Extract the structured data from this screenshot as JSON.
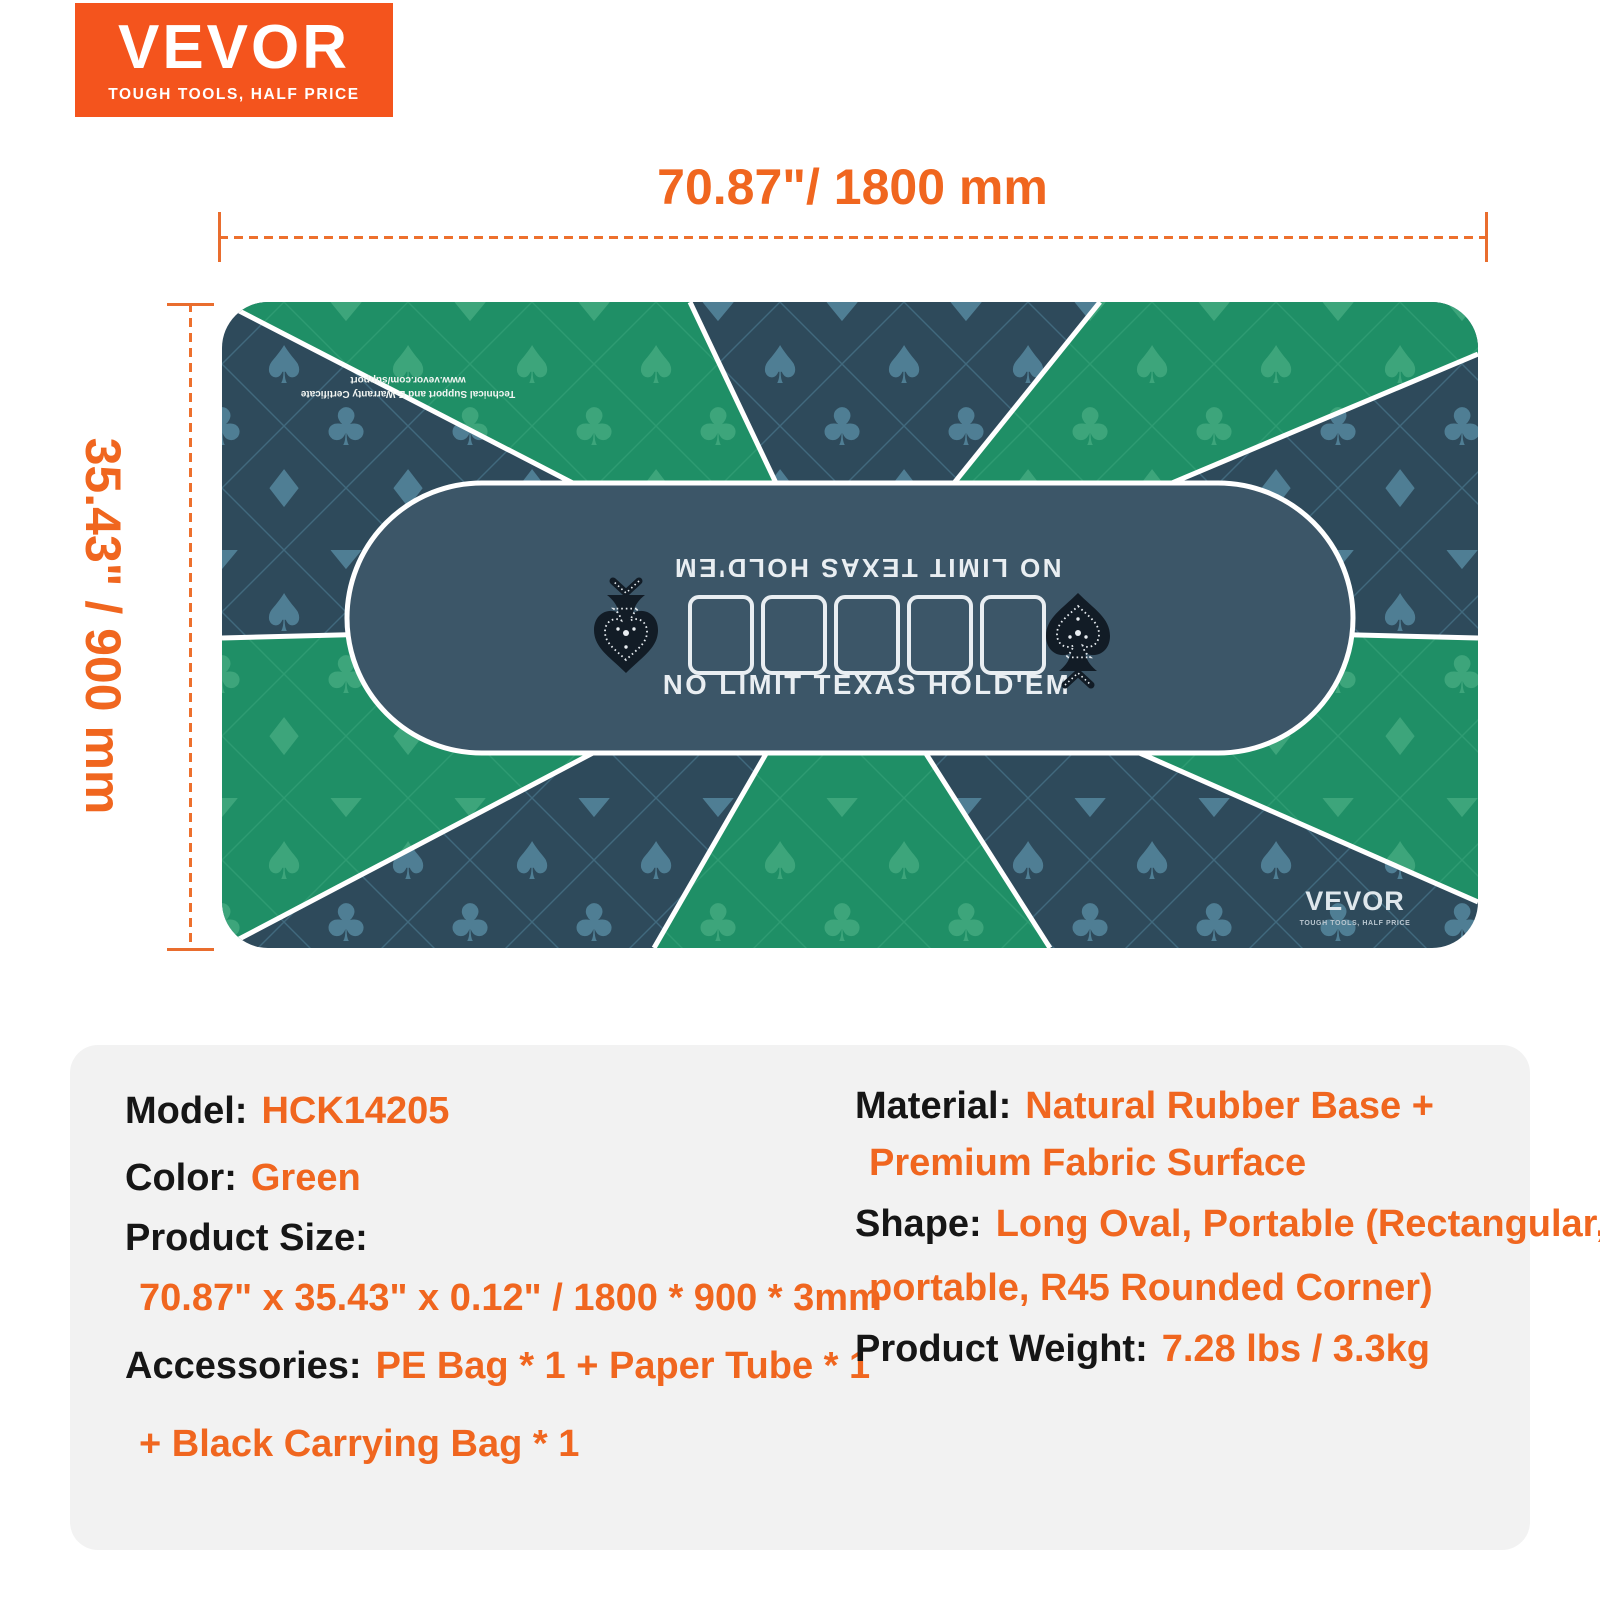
{
  "brand": {
    "name": "VEVOR",
    "tagline": "TOUGH TOOLS, HALF PRICE"
  },
  "dimensions": {
    "width_label": "70.87\"/ 1800 mm",
    "height_label": "35.43\" / 900 mm"
  },
  "mat": {
    "center_text_top_reversed": "NO LIMIT TEXAS HOLD'EM",
    "center_text_bottom": "NO LIMIT TEXAS HOLD'EM",
    "support_line1": "Technical Support and E-Warranty Certificate",
    "support_line2": "www.vevor.com/support",
    "mat_logo": "VEVOR",
    "mat_logo_tagline": "TOUGH TOOLS, HALF PRICE",
    "card_count": "5",
    "pattern_suits": {
      "spade": "♠",
      "club": "♣",
      "diamond": "♦",
      "heart": "♥"
    },
    "colors": {
      "green": "#1F8F66",
      "green_symbol": "#3DA57B",
      "green_lattice": "#2E9B72",
      "dark": "#2E4A5B",
      "dark_symbol": "#4F7E94",
      "dark_lattice": "#41697D",
      "oval": "#3C5668",
      "divider": "#FFFFFF"
    }
  },
  "panel": {
    "rows_left": [
      {
        "label": "Model:",
        "value": "HCK14205"
      },
      {
        "label": "Color:",
        "value": "Green"
      },
      {
        "label": "Product Size:",
        "value": ""
      },
      {
        "label": "",
        "value": "70.87\" x 35.43\" x 0.12\" / 1800 * 900 * 3mm"
      },
      {
        "label": "Accessories:",
        "value": "PE Bag * 1 + Paper Tube * 1"
      },
      {
        "label": "",
        "value": "+ Black Carrying Bag * 1"
      }
    ],
    "rows_right": [
      {
        "label": "Material:",
        "value": "Natural Rubber Base +"
      },
      {
        "label": "",
        "value": "Premium Fabric Surface"
      },
      {
        "label": "Shape:",
        "value": "Long Oval, Portable (Rectangular,"
      },
      {
        "label": "",
        "value": "portable, R45 Rounded Corner)"
      },
      {
        "label": "Product Weight:",
        "value": "7.28 lbs / 3.3kg"
      }
    ]
  },
  "colors": {
    "logo_orange": "#F4541D",
    "accent_orange": "#F0661F",
    "dim_line_orange": "#ED702D",
    "panel_bg": "#F2F2F2",
    "text_black": "#161616"
  }
}
